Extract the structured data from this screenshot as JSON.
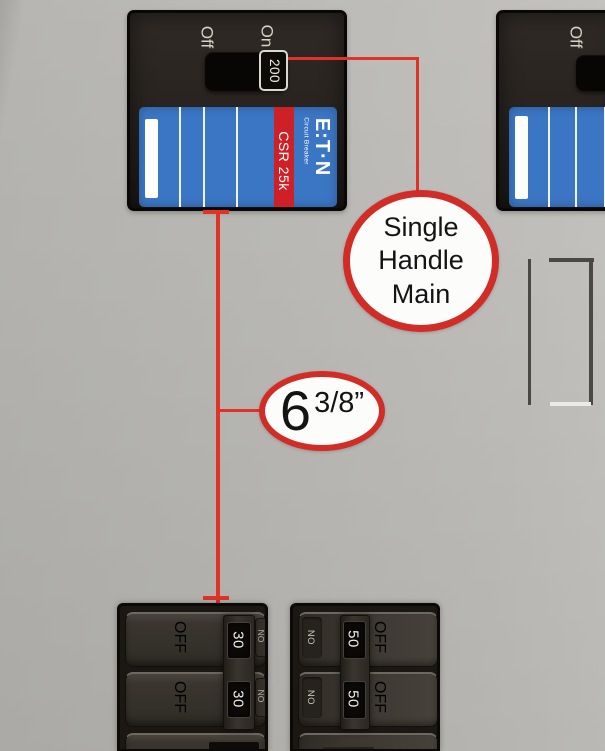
{
  "colors": {
    "accent_red": "#e03227",
    "callout_red": "#d22c26",
    "breaker_blue": "#3b76c4",
    "stripe_red": "#ce2127"
  },
  "main_breaker": {
    "off_label": "Off",
    "on_label": "On",
    "amp_rating": "200",
    "model": "CSR 25k",
    "brand_logo": "E:T·N",
    "brand_sub": "Circuit Breaker"
  },
  "secondary_breaker": {
    "off_label": "Off"
  },
  "callouts": {
    "single_handle": {
      "line1": "Single",
      "line2": "Handle",
      "line3": "Main"
    },
    "measurement": {
      "whole": "6",
      "fraction": "3/8”"
    }
  },
  "left_panel": {
    "rows": [
      {
        "state": "OFF",
        "amp": "30",
        "hidden_state": "ON"
      },
      {
        "state": "OFF",
        "amp": "30",
        "hidden_state": "ON"
      }
    ]
  },
  "right_panel": {
    "rows": [
      {
        "on": "ON",
        "amp": "50",
        "off": "OFF"
      },
      {
        "on": "ON",
        "amp": "50",
        "off": "OFF"
      }
    ]
  }
}
